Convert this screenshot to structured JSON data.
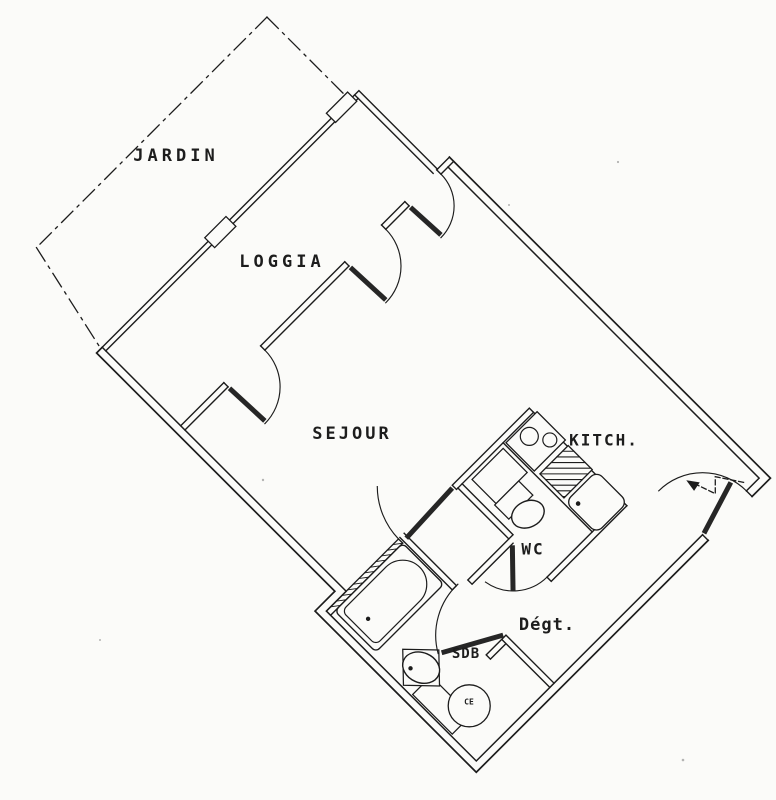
{
  "page": {
    "background": "#fbfbf9",
    "ink": "#1c1c1c",
    "description": "Scanned architectural floor plan of a studio apartment, rotated about 45 degrees, black line work on white paper"
  },
  "floor_plan": {
    "rotation_deg": 45,
    "labels": {
      "jardin": "JARDIN",
      "loggia": "LOGGIA",
      "sejour": "SEJOUR",
      "kitchen": "KITCH.",
      "wc": "WC",
      "degagement": "Dégt.",
      "sdb": "SDB",
      "water_heater": "CE"
    },
    "fixtures": [
      "stove-two-burners-icon",
      "counter-drainer-hatch-icon",
      "kitchen-sink-icon",
      "toilet-icon",
      "bathtub-icon",
      "washbasin-icon",
      "water-heater-circle-icon",
      "entry-arrow-icon"
    ],
    "boundaries": {
      "property_line_style": "dash-dot",
      "entrance_side": "south-east wall near east corner",
      "loggia_doors": 3
    }
  }
}
